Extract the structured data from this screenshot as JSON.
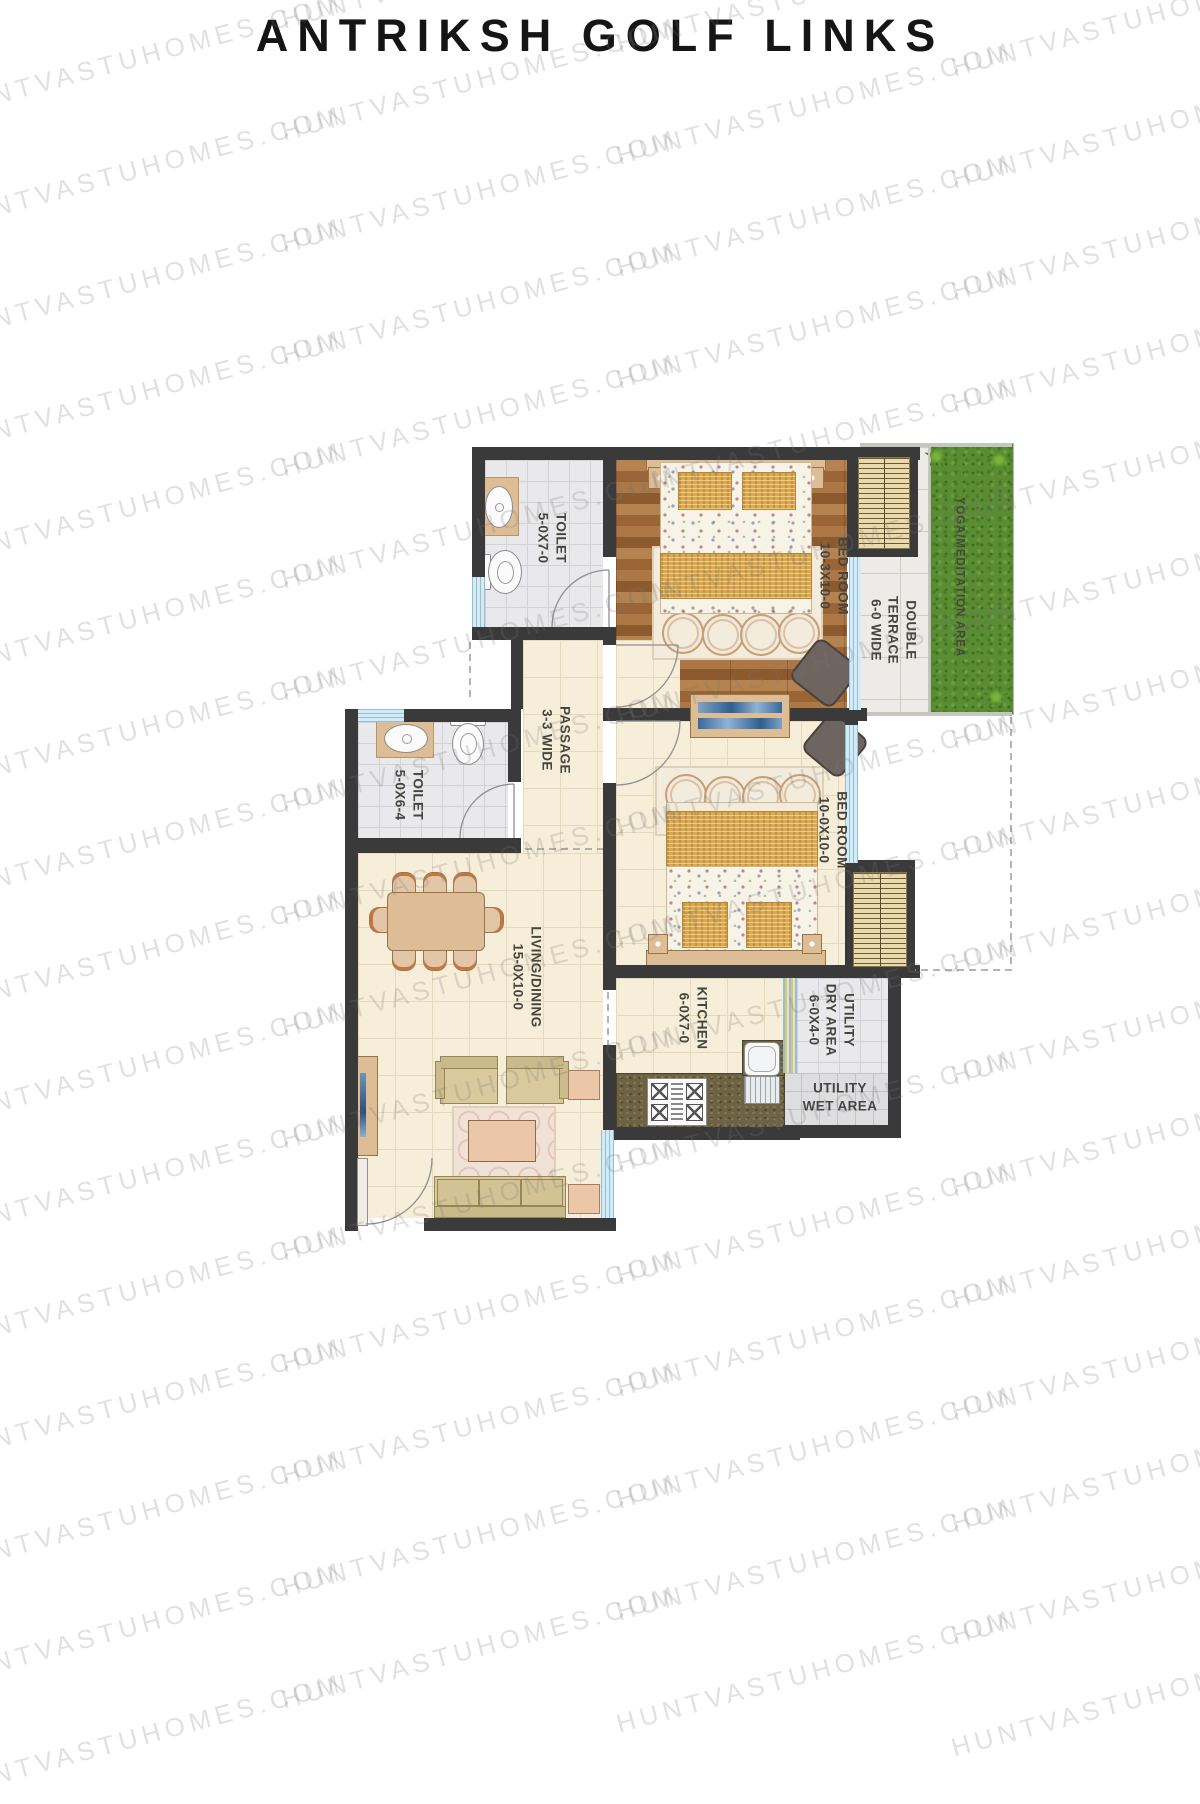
{
  "title": "ANTRIKSH GOLF LINKS",
  "watermark": {
    "text": "HUNTVASTUHOMES.COM"
  },
  "plan": {
    "rooms": {
      "toilet1": {
        "label": "TOILET",
        "dims": "5-0X7-0"
      },
      "bedroom1": {
        "label": "BED ROOM",
        "dims": "10-3X10-0"
      },
      "terrace": {
        "label_line1": "DOUBLE",
        "label_line2": "TERRACE",
        "dims": "6-0 WIDE"
      },
      "yoga": {
        "label": "YOGA/MEDITATION AREA"
      },
      "passage": {
        "label": "PASSAGE",
        "dims": "3-3 WIDE"
      },
      "toilet2": {
        "label": "TOILET",
        "dims": "5-0X6-4"
      },
      "bedroom2": {
        "label": "BED ROOM",
        "dims": "10-0X10-0"
      },
      "living": {
        "label": "LIVING/DINING",
        "dims": "15-0X10-0"
      },
      "kitchen": {
        "label": "KITCHEN",
        "dims": "6-0X7-0"
      },
      "utility_dry": {
        "label_line1": "UTILITY",
        "label_line2": "DRY AREA",
        "dims": "6-0X4-0"
      },
      "utility_wet": {
        "label_line1": "UTILITY",
        "label_line2": "WET AREA"
      }
    },
    "colors": {
      "wall": "#3a3a3a",
      "wood_floor": "#a8713f",
      "cream_floor": "#f6eed8",
      "gray_tile": "#e9e9eb",
      "grass": "#5a8d33",
      "window": "#d5eaf3",
      "gold_fabric": "#d9a850"
    }
  }
}
